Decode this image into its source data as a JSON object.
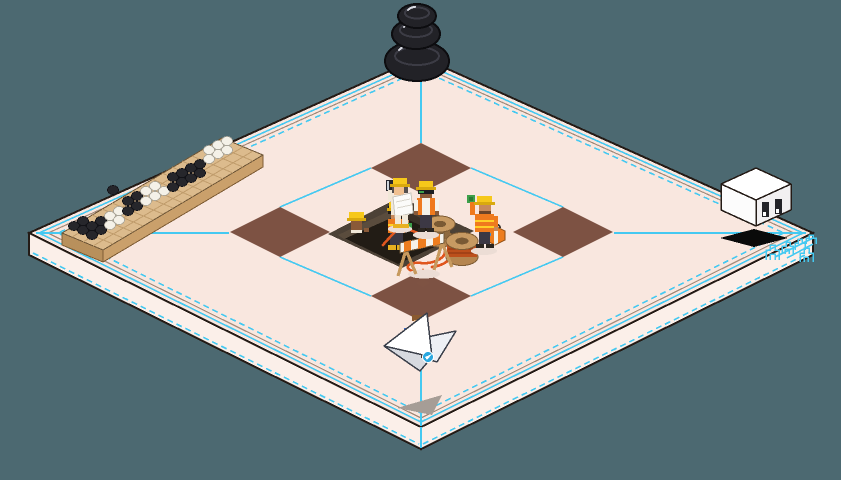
{
  "scene": {
    "kind": "isometric-pixel-art-construction-scene"
  },
  "palette": {
    "bg": "#4c6971",
    "ink": "#241b16",
    "floorTop": "#f9e7df",
    "floorSide": "#fbefe9",
    "cyan": "#45c9f1",
    "tan": "#a38b7b",
    "tile": "#7d5243",
    "pitTop": "#4c4136",
    "pitWallL": "#5a4c3d",
    "pitWallR": "#3b3128",
    "pitFloor": "#221c15",
    "cable": "#e0561e",
    "cableWrap": "#bc4f1c",
    "wood": "#c79a62",
    "woodMid": "#b5854f",
    "woodDark": "#7e5c34",
    "boardTop": "#dcbb8d",
    "boardSideA": "#caa06b",
    "boardSideB": "#b8905c",
    "boardGrid": "#c09c6c",
    "stoneB": "#26262b",
    "stoneBEdge": "#121217",
    "stoneW": "#f4f1e8",
    "stoneWEdge": "#aaa69a",
    "hatYellow": "#f6c81a",
    "hatBrim": "#d9a90e",
    "vestOrange": "#ef7a1e",
    "hiVis": "#ffd028",
    "pants": "#3c3844",
    "shirt": "#f5f2ea",
    "cream": "#f1e8d8",
    "skinLight": "#f0c090",
    "skinMid": "#c8895a",
    "skinDark": "#8a5a38",
    "gloveGreen": "#3da04a",
    "bootYellow": "#e8b020",
    "shoeDark": "#2c2620",
    "toolboxOrange": "#ed7d1f",
    "blue": "#3a6fd8",
    "badgeBlue": "#2aa8df",
    "planeWhite": "#ffffff",
    "planeShade": "#d7dae0",
    "planeLight": "#eef0f4",
    "planeEdge": "#3a3f4a",
    "shadowGray": "#a69d96",
    "softShadow": "#ecddd5",
    "stoneZen": "#222227",
    "stoneZenRing": "#3c3c45",
    "stoneZenGleam": "#d8dae2",
    "cubeTop": "#ffffff",
    "cubeLeft": "#fcfcfc",
    "cubeRight": "#f2f0f1",
    "cubeShadow": "#0a0a0a"
  },
  "guide_lines": [
    {
      "x1": 421,
      "y1": 62,
      "x2": 421,
      "y2": 143
    },
    {
      "x1": 421,
      "y1": 321,
      "x2": 421,
      "y2": 426
    },
    {
      "x1": 421,
      "y1": 427,
      "x2": 421,
      "y2": 448
    },
    {
      "x1": 36,
      "y1": 233,
      "x2": 229,
      "y2": 233
    },
    {
      "x1": 614,
      "y1": 233,
      "x2": 806,
      "y2": 233
    },
    {
      "x1": 471,
      "y1": 168,
      "x2": 563,
      "y2": 207
    },
    {
      "x1": 563,
      "y1": 257,
      "x2": 471,
      "y2": 296
    },
    {
      "x1": 371,
      "y1": 296,
      "x2": 280,
      "y2": 257
    },
    {
      "x1": 280,
      "y1": 207,
      "x2": 371,
      "y2": 168
    },
    {
      "x1": 813,
      "y1": 238,
      "x2": 775,
      "y2": 257
    },
    {
      "x1": 813,
      "y1": 244,
      "x2": 787,
      "y2": 258
    }
  ],
  "tiles": [
    {
      "points": "421,143 471,168 421,193 371,168"
    },
    {
      "points": "563,207 613,232 563,257 513,232"
    },
    {
      "points": "421,271 471,296 421,321 371,296"
    },
    {
      "points": "280,207 330,232 280,257 230,232"
    }
  ],
  "board_grid": [
    {
      "x1": 72,
      "y1": 227,
      "x2": 113,
      "y2": 244
    },
    {
      "x1": 82,
      "y1": 221,
      "x2": 123,
      "y2": 238
    },
    {
      "x1": 92,
      "y1": 215,
      "x2": 133,
      "y2": 232
    },
    {
      "x1": 102,
      "y1": 209,
      "x2": 143,
      "y2": 226
    },
    {
      "x1": 112,
      "y1": 203,
      "x2": 153,
      "y2": 220
    },
    {
      "x1": 122,
      "y1": 197,
      "x2": 163,
      "y2": 214
    },
    {
      "x1": 132,
      "y1": 191,
      "x2": 173,
      "y2": 208
    },
    {
      "x1": 142,
      "y1": 185,
      "x2": 183,
      "y2": 203
    },
    {
      "x1": 152,
      "y1": 179,
      "x2": 193,
      "y2": 197
    },
    {
      "x1": 162,
      "y1": 173,
      "x2": 203,
      "y2": 191
    },
    {
      "x1": 172,
      "y1": 167,
      "x2": 213,
      "y2": 185
    },
    {
      "x1": 182,
      "y1": 161,
      "x2": 223,
      "y2": 179
    },
    {
      "x1": 192,
      "y1": 156,
      "x2": 233,
      "y2": 173
    },
    {
      "x1": 202,
      "y1": 150,
      "x2": 243,
      "y2": 167
    },
    {
      "x1": 212,
      "y1": 144,
      "x2": 253,
      "y2": 161
    },
    {
      "x1": 72,
      "y1": 237,
      "x2": 232,
      "y2": 142
    },
    {
      "x1": 83,
      "y1": 242,
      "x2": 243,
      "y2": 147
    },
    {
      "x1": 93,
      "y1": 246,
      "x2": 253,
      "y2": 151
    }
  ],
  "go_stones": [
    {
      "x": 74,
      "y": 226,
      "k": "sb"
    },
    {
      "x": 83,
      "y": 230,
      "k": "sb"
    },
    {
      "x": 92,
      "y": 235,
      "k": "sb"
    },
    {
      "x": 83,
      "y": 221,
      "k": "sb"
    },
    {
      "x": 92,
      "y": 226,
      "k": "sb"
    },
    {
      "x": 101,
      "y": 230,
      "k": "sb"
    },
    {
      "x": 101,
      "y": 221,
      "k": "sb"
    },
    {
      "x": 110,
      "y": 216,
      "k": "sw"
    },
    {
      "x": 119,
      "y": 211,
      "k": "sw"
    },
    {
      "x": 110,
      "y": 225,
      "k": "sw"
    },
    {
      "x": 119,
      "y": 220,
      "k": "sw"
    },
    {
      "x": 113,
      "y": 190,
      "k": "sb"
    },
    {
      "x": 128,
      "y": 211,
      "k": "sb"
    },
    {
      "x": 137,
      "y": 206,
      "k": "sb"
    },
    {
      "x": 128,
      "y": 201,
      "k": "sb"
    },
    {
      "x": 137,
      "y": 196,
      "k": "sb"
    },
    {
      "x": 146,
      "y": 201,
      "k": "sw"
    },
    {
      "x": 155,
      "y": 196,
      "k": "sw"
    },
    {
      "x": 146,
      "y": 191,
      "k": "sw"
    },
    {
      "x": 164,
      "y": 191,
      "k": "sw"
    },
    {
      "x": 155,
      "y": 186,
      "k": "sw"
    },
    {
      "x": 173,
      "y": 187,
      "k": "sb"
    },
    {
      "x": 182,
      "y": 182,
      "k": "sb"
    },
    {
      "x": 173,
      "y": 177,
      "k": "sb"
    },
    {
      "x": 191,
      "y": 178,
      "k": "sb"
    },
    {
      "x": 182,
      "y": 173,
      "k": "sb"
    },
    {
      "x": 200,
      "y": 173,
      "k": "sb"
    },
    {
      "x": 191,
      "y": 168,
      "k": "sb"
    },
    {
      "x": 200,
      "y": 164,
      "k": "sb"
    },
    {
      "x": 209,
      "y": 159,
      "k": "sw"
    },
    {
      "x": 218,
      "y": 154,
      "k": "sw"
    },
    {
      "x": 209,
      "y": 150,
      "k": "sw"
    },
    {
      "x": 227,
      "y": 150,
      "k": "sw"
    },
    {
      "x": 218,
      "y": 145,
      "k": "sw"
    },
    {
      "x": 227,
      "y": 141,
      "k": "sw"
    }
  ],
  "corner_glyphs": [
    {
      "d": "M766,260 v-10 h4 v-5 h5 v5 h4 v10 M770,260 v-6 h5 v6"
    },
    {
      "d": "M782,254 v-8 h4 v-4 h4 v4 h3 v8 M785,254 v-5 h4 v5"
    },
    {
      "d": "M795,250 v-7 h3 v-4 h4 v4 h3 v7"
    },
    {
      "d": "M800,262 v-9 h4 v-5 h5 v5 h4 v9 M804,262 v-5 h4 v5"
    },
    {
      "d": "M806,244 v-6 h3 v-3 h4 v3 h3 v6"
    }
  ]
}
